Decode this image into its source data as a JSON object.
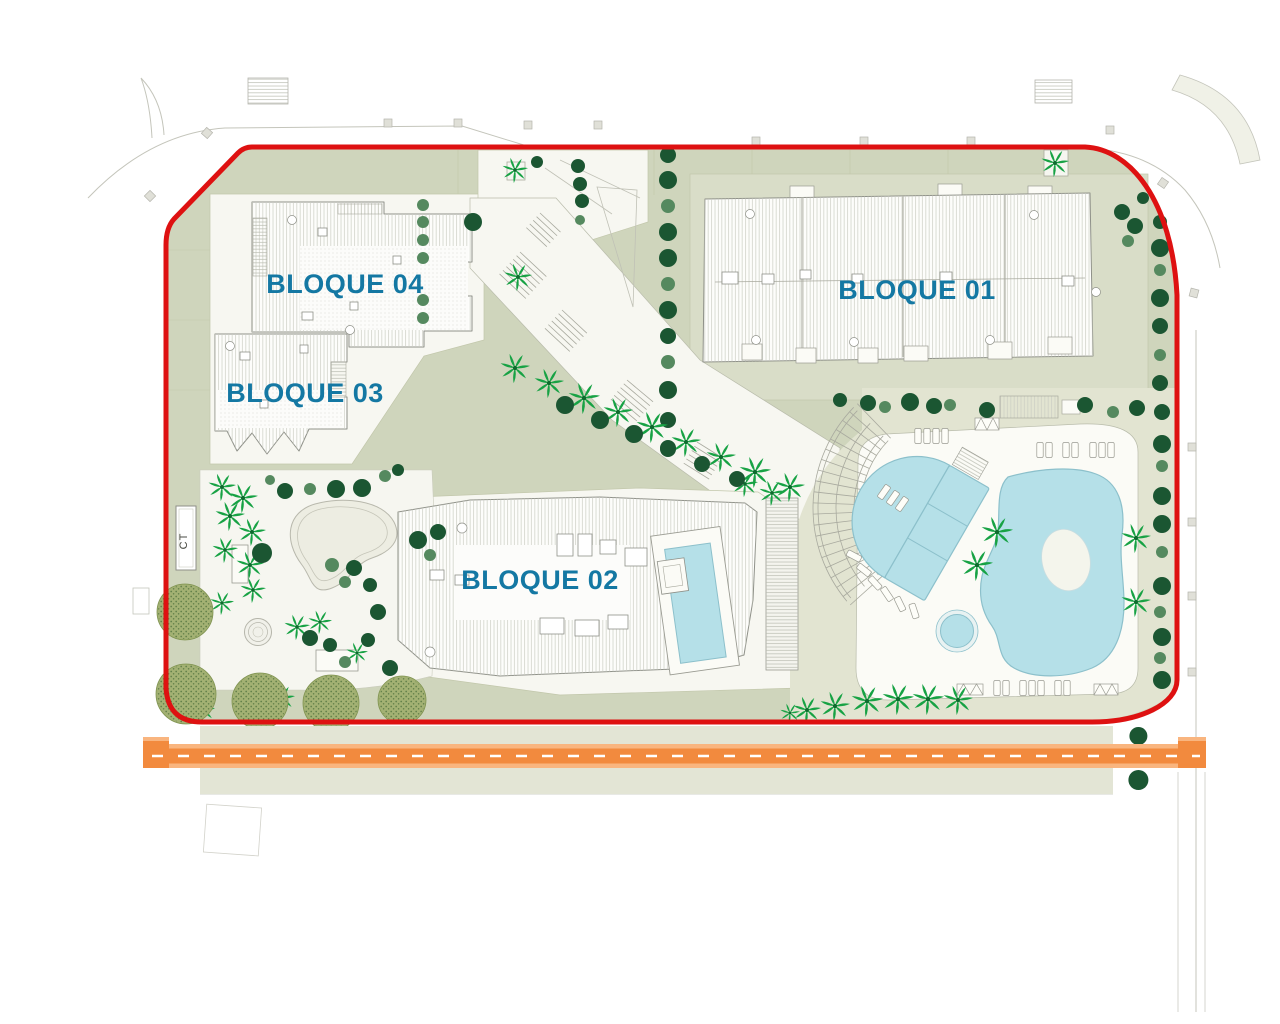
{
  "labels": {
    "bloque01": "BLOQUE 01",
    "bloque02": "BLOQUE 02",
    "bloque03": "BLOQUE 03",
    "bloque04": "BLOQUE 04",
    "ct": "CT"
  },
  "colors": {
    "boundary_red": "#DE1111",
    "label_teal": "#1478A3",
    "ground_sage": "#CFD5BC",
    "ground_pad": "#D9DDC8",
    "ground_beige": "#E2E4D1",
    "strip_beige": "#E3E5D5",
    "plaza_white": "#F7F7F1",
    "deck_white": "#FBFBF6",
    "pool_blue": "#B5E0E8",
    "pool_stroke": "#8CC0CB",
    "road_orange": "#F28A3E",
    "road_stripe": "#F9B57F",
    "road_dash": "#FFFFFF",
    "tree_dark": "#1B5632",
    "tree_medium": "#55895F",
    "palm_green": "#17A244",
    "canopy_green": "#A3B173",
    "line_gray": "#9A9B92",
    "faint_gray": "#C4C5BB"
  },
  "map": {
    "tree_rows": [
      {
        "y": 736,
        "x0": 212,
        "dx": 38.6,
        "n": 25,
        "r": 9
      },
      {
        "y": 780,
        "x0": 212,
        "dx": 38.6,
        "n": 25,
        "r": 10
      }
    ],
    "trees": [
      [
        668,
        155,
        "d",
        8
      ],
      [
        668,
        180,
        "d",
        9
      ],
      [
        668,
        206,
        "m",
        7
      ],
      [
        668,
        232,
        "d",
        9
      ],
      [
        668,
        258,
        "d",
        9
      ],
      [
        668,
        284,
        "m",
        7
      ],
      [
        668,
        310,
        "d",
        9
      ],
      [
        668,
        336,
        "d",
        8
      ],
      [
        668,
        362,
        "m",
        7
      ],
      [
        668,
        390,
        "d",
        9
      ],
      [
        668,
        420,
        "d",
        8
      ],
      [
        668,
        448,
        "d",
        8
      ],
      [
        1160,
        222,
        "d",
        7
      ],
      [
        1160,
        248,
        "d",
        9
      ],
      [
        1160,
        270,
        "m",
        6
      ],
      [
        1160,
        298,
        "d",
        9
      ],
      [
        1160,
        326,
        "d",
        8
      ],
      [
        1160,
        355,
        "m",
        6
      ],
      [
        1160,
        383,
        "d",
        8
      ],
      [
        1162,
        412,
        "d",
        8
      ],
      [
        1162,
        444,
        "d",
        9
      ],
      [
        1162,
        466,
        "m",
        6
      ],
      [
        1162,
        496,
        "d",
        9
      ],
      [
        1162,
        524,
        "d",
        9
      ],
      [
        1162,
        552,
        "m",
        6
      ],
      [
        1162,
        586,
        "d",
        9
      ],
      [
        1160,
        612,
        "m",
        6
      ],
      [
        1162,
        637,
        "d",
        9
      ],
      [
        1160,
        658,
        "m",
        6
      ],
      [
        1162,
        680,
        "d",
        9
      ],
      [
        423,
        205,
        "m",
        6
      ],
      [
        423,
        222,
        "m",
        6
      ],
      [
        423,
        240,
        "m",
        6
      ],
      [
        423,
        258,
        "m",
        6
      ],
      [
        423,
        300,
        "m",
        6
      ],
      [
        423,
        318,
        "m",
        6
      ],
      [
        515,
        368,
        "p",
        15
      ],
      [
        549,
        383,
        "p",
        15
      ],
      [
        584,
        398,
        "p",
        16
      ],
      [
        618,
        412,
        "p",
        15
      ],
      [
        652,
        427,
        "p",
        16
      ],
      [
        686,
        442,
        "p",
        15
      ],
      [
        721,
        457,
        "p",
        15
      ],
      [
        755,
        472,
        "p",
        16
      ],
      [
        790,
        487,
        "p",
        15
      ],
      [
        745,
        484,
        "p",
        13
      ],
      [
        772,
        493,
        "p",
        13
      ],
      [
        565,
        405,
        "d",
        9
      ],
      [
        600,
        420,
        "d",
        9
      ],
      [
        634,
        434,
        "d",
        9
      ],
      [
        668,
        449,
        "d",
        8
      ],
      [
        702,
        464,
        "d",
        8
      ],
      [
        737,
        479,
        "d",
        8
      ],
      [
        473,
        222,
        "d",
        9
      ],
      [
        518,
        277,
        "p",
        14
      ],
      [
        515,
        170,
        "p",
        13
      ],
      [
        537,
        162,
        "d",
        6
      ],
      [
        578,
        166,
        "d",
        7
      ],
      [
        580,
        184,
        "d",
        7
      ],
      [
        582,
        201,
        "d",
        7
      ],
      [
        580,
        220,
        "m",
        5
      ],
      [
        1055,
        163,
        "p",
        14
      ],
      [
        1122,
        212,
        "d",
        8
      ],
      [
        1135,
        226,
        "d",
        8
      ],
      [
        1128,
        241,
        "m",
        6
      ],
      [
        1143,
        198,
        "d",
        6
      ],
      [
        840,
        400,
        "d",
        7
      ],
      [
        868,
        403,
        "d",
        8
      ],
      [
        885,
        407,
        "m",
        6
      ],
      [
        910,
        402,
        "d",
        9
      ],
      [
        934,
        406,
        "d",
        8
      ],
      [
        950,
        405,
        "m",
        6
      ],
      [
        987,
        410,
        "d",
        8
      ],
      [
        1085,
        405,
        "d",
        8
      ],
      [
        1113,
        412,
        "m",
        6
      ],
      [
        1137,
        408,
        "d",
        8
      ],
      [
        997,
        532,
        "p",
        16
      ],
      [
        977,
        565,
        "p",
        16
      ],
      [
        1136,
        538,
        "p",
        15
      ],
      [
        1136,
        602,
        "p",
        15
      ],
      [
        790,
        713,
        "p",
        10
      ],
      [
        807,
        710,
        "p",
        14
      ],
      [
        835,
        706,
        "p",
        15
      ],
      [
        867,
        701,
        "p",
        16
      ],
      [
        898,
        699,
        "p",
        16
      ],
      [
        928,
        699,
        "p",
        16
      ],
      [
        958,
        700,
        "p",
        15
      ],
      [
        222,
        487,
        "p",
        14
      ],
      [
        243,
        498,
        "p",
        15
      ],
      [
        230,
        516,
        "p",
        15
      ],
      [
        252,
        532,
        "p",
        14
      ],
      [
        225,
        550,
        "p",
        13
      ],
      [
        250,
        565,
        "p",
        14
      ],
      [
        253,
        590,
        "p",
        13
      ],
      [
        222,
        603,
        "p",
        12
      ],
      [
        297,
        627,
        "p",
        13
      ],
      [
        320,
        622,
        "p",
        12
      ],
      [
        282,
        698,
        "p",
        13
      ],
      [
        203,
        710,
        "p",
        12
      ],
      [
        357,
        653,
        "p",
        11
      ],
      [
        262,
        553,
        "d",
        10
      ],
      [
        188,
        601,
        "d",
        9
      ],
      [
        332,
        565,
        "m",
        7
      ],
      [
        354,
        568,
        "d",
        8
      ],
      [
        370,
        585,
        "d",
        7
      ],
      [
        345,
        582,
        "m",
        6
      ],
      [
        418,
        540,
        "d",
        9
      ],
      [
        438,
        532,
        "d",
        8
      ],
      [
        430,
        555,
        "m",
        6
      ],
      [
        310,
        638,
        "d",
        8
      ],
      [
        330,
        645,
        "d",
        7
      ],
      [
        345,
        662,
        "m",
        6
      ],
      [
        378,
        612,
        "d",
        8
      ],
      [
        368,
        640,
        "d",
        7
      ],
      [
        390,
        668,
        "d",
        8
      ],
      [
        270,
        480,
        "m",
        5
      ],
      [
        285,
        491,
        "d",
        8
      ],
      [
        310,
        489,
        "m",
        6
      ],
      [
        336,
        489,
        "d",
        9
      ],
      [
        362,
        488,
        "d",
        9
      ],
      [
        385,
        476,
        "m",
        6
      ],
      [
        398,
        470,
        "d",
        6
      ],
      [
        185,
        612,
        "c",
        28
      ],
      [
        186,
        694,
        "c",
        30
      ],
      [
        260,
        701,
        "c",
        28
      ],
      [
        331,
        703,
        "c",
        28
      ],
      [
        402,
        700,
        "c",
        24
      ]
    ],
    "loungers": [
      [
        918,
        436,
        0
      ],
      [
        927,
        436,
        0
      ],
      [
        936,
        436,
        0
      ],
      [
        945,
        436,
        0
      ],
      [
        1040,
        450,
        0
      ],
      [
        1049,
        450,
        0
      ],
      [
        1066,
        450,
        0
      ],
      [
        1075,
        450,
        0
      ],
      [
        1093,
        450,
        0
      ],
      [
        1102,
        450,
        0
      ],
      [
        1111,
        450,
        0
      ],
      [
        997,
        688,
        0
      ],
      [
        1006,
        688,
        0
      ],
      [
        1023,
        688,
        0
      ],
      [
        1032,
        688,
        0
      ],
      [
        1041,
        688,
        0
      ],
      [
        1058,
        688,
        0
      ],
      [
        1067,
        688,
        0
      ],
      [
        854,
        556,
        -62
      ],
      [
        864,
        570,
        -52
      ],
      [
        875,
        583,
        -43
      ],
      [
        887,
        594,
        -34
      ],
      [
        900,
        604,
        -26
      ],
      [
        914,
        611,
        -18
      ],
      [
        884,
        492,
        35
      ],
      [
        893,
        498,
        35
      ],
      [
        902,
        504,
        35
      ]
    ],
    "xboxes": [
      [
        957,
        684,
        26,
        11
      ],
      [
        1094,
        684,
        24,
        11
      ],
      [
        975,
        418,
        24,
        12
      ]
    ]
  }
}
